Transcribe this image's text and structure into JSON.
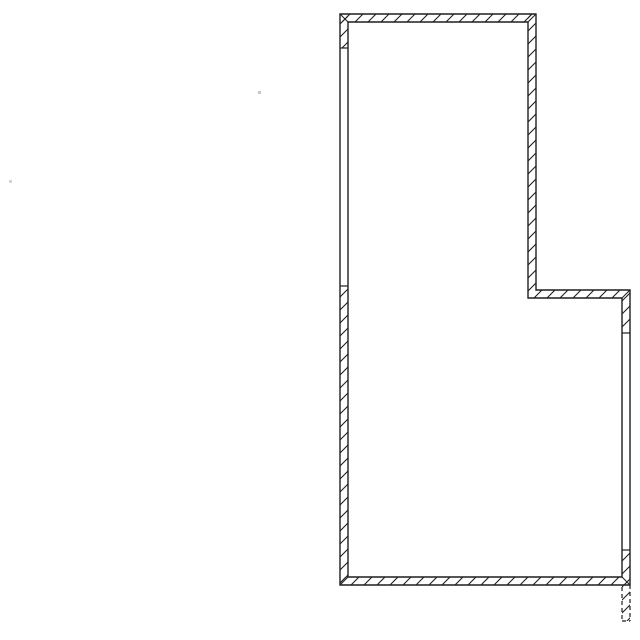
{
  "drawing": {
    "title": "floor-plan-wall-outline",
    "canvas": {
      "width": 640,
      "height": 640,
      "background": "#ffffff"
    },
    "stroke": {
      "color": "#1f1f1f",
      "contour_width": 1.4,
      "hatch_width": 1.1,
      "tick_width": 1.2,
      "hatch_spacing": 13
    },
    "outer_contour": [
      [
        340,
        14
      ],
      [
        536,
        14
      ],
      [
        536,
        290
      ],
      [
        630,
        290
      ],
      [
        630,
        585
      ],
      [
        340,
        585
      ]
    ],
    "inner_contour": [
      [
        348,
        22
      ],
      [
        528,
        22
      ],
      [
        528,
        298
      ],
      [
        622,
        298
      ],
      [
        622,
        577
      ],
      [
        348,
        577
      ]
    ],
    "hatched_segments": [
      {
        "name": "top-wall",
        "x": 340,
        "y": 14,
        "w": 196,
        "h": 8
      },
      {
        "name": "left-wall-upper-stub",
        "x": 340,
        "y": 14,
        "w": 8,
        "h": 34
      },
      {
        "name": "left-wall-lower",
        "x": 340,
        "y": 286,
        "w": 8,
        "h": 299
      },
      {
        "name": "right-wall-upper",
        "x": 528,
        "y": 14,
        "w": 8,
        "h": 276
      },
      {
        "name": "notch-wall",
        "x": 528,
        "y": 290,
        "w": 102,
        "h": 8
      },
      {
        "name": "right-wall-stub",
        "x": 622,
        "y": 298,
        "w": 8,
        "h": 35
      },
      {
        "name": "right-wall-low",
        "x": 622,
        "y": 550,
        "w": 8,
        "h": 27
      },
      {
        "name": "bottom-wall",
        "x": 340,
        "y": 577,
        "w": 290,
        "h": 8
      },
      {
        "name": "hidden-stub-fill",
        "x": 622,
        "y": 585,
        "w": 8,
        "h": 36
      }
    ],
    "ticks": [
      [
        340,
        48,
        348,
        48
      ],
      [
        340,
        286,
        348,
        286
      ],
      [
        622,
        333,
        630,
        333
      ],
      [
        622,
        550,
        630,
        550
      ]
    ],
    "miters": [
      [
        340,
        14,
        348,
        22
      ],
      [
        536,
        14,
        528,
        22
      ],
      [
        630,
        290,
        622,
        298
      ],
      [
        340,
        585,
        348,
        577
      ],
      [
        630,
        585,
        622,
        577
      ]
    ],
    "dashed_stub": {
      "dash": "4 3",
      "lines": [
        [
          622,
          587,
          622,
          621
        ],
        [
          630,
          585,
          630,
          621
        ],
        [
          622,
          621,
          630,
          621
        ]
      ]
    },
    "specks": [
      {
        "x": 258,
        "y": 91,
        "size": 3,
        "color": "#c9c9c9"
      },
      {
        "x": 9,
        "y": 180,
        "size": 3,
        "color": "#d4d4d4"
      }
    ]
  }
}
